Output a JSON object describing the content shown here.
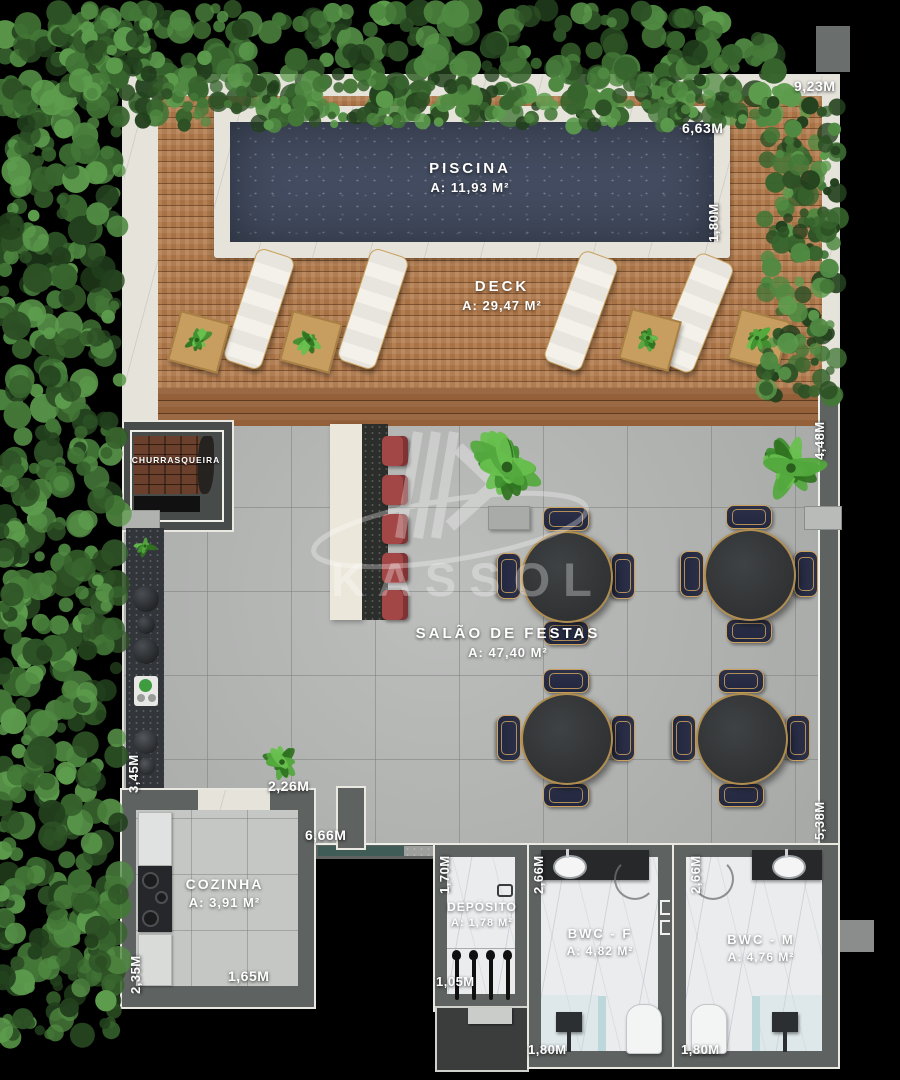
{
  "watermark": {
    "brand": "KASSOL"
  },
  "rooms": {
    "piscina": {
      "name": "PISCINA",
      "area": "A: 11,93 M²"
    },
    "deck": {
      "name": "DECK",
      "area": "A: 29,47 M²"
    },
    "salao": {
      "name": "SALÃO DE FESTAS",
      "area": "A: 47,40 M²"
    },
    "churrasqueira": {
      "name": "CHURRASQUEIRA"
    },
    "cozinha": {
      "name": "COZINHA",
      "area": "A: 3,91 M²"
    },
    "deposito": {
      "name": "DEPÓSITO",
      "area": "A: 1,78 M²"
    },
    "bwc_f": {
      "name": "BWC - F",
      "area": "A: 4,82 M²"
    },
    "bwc_m": {
      "name": "BWC - M",
      "area": "A: 4,76 M²"
    }
  },
  "dimensions": {
    "top_right": "9,23M",
    "pool_width": "6,63M",
    "pool_depth": "1,80M",
    "right_upper": "4,48M",
    "right_lower": "5,38M",
    "counter_left": "3,45M",
    "cozinha_top": "2,26M",
    "salao_bottom": "6,66M",
    "cozinha_left": "2,35M",
    "cozinha_bottom": "1,65M",
    "deposito_left": "1,70M",
    "deposito_bottom": "1,05M",
    "bwcf_left": "2,66M",
    "bwcf_bottom": "1,80M",
    "bwcm_left": "2,66M",
    "bwcm_bottom": "1,80M"
  },
  "colors": {
    "background": "#000000",
    "pool": "#424b5f",
    "deck_wood": "#b0784a",
    "tile_gray": "#b5b7b5",
    "wall_gray": "#5e6260",
    "hedge_green": "#3a5c30",
    "bar_stool_red": "#a34646",
    "chair_navy": "#2a2f45",
    "gold_trim": "#c9a05a",
    "label_text": "#ffffff"
  }
}
